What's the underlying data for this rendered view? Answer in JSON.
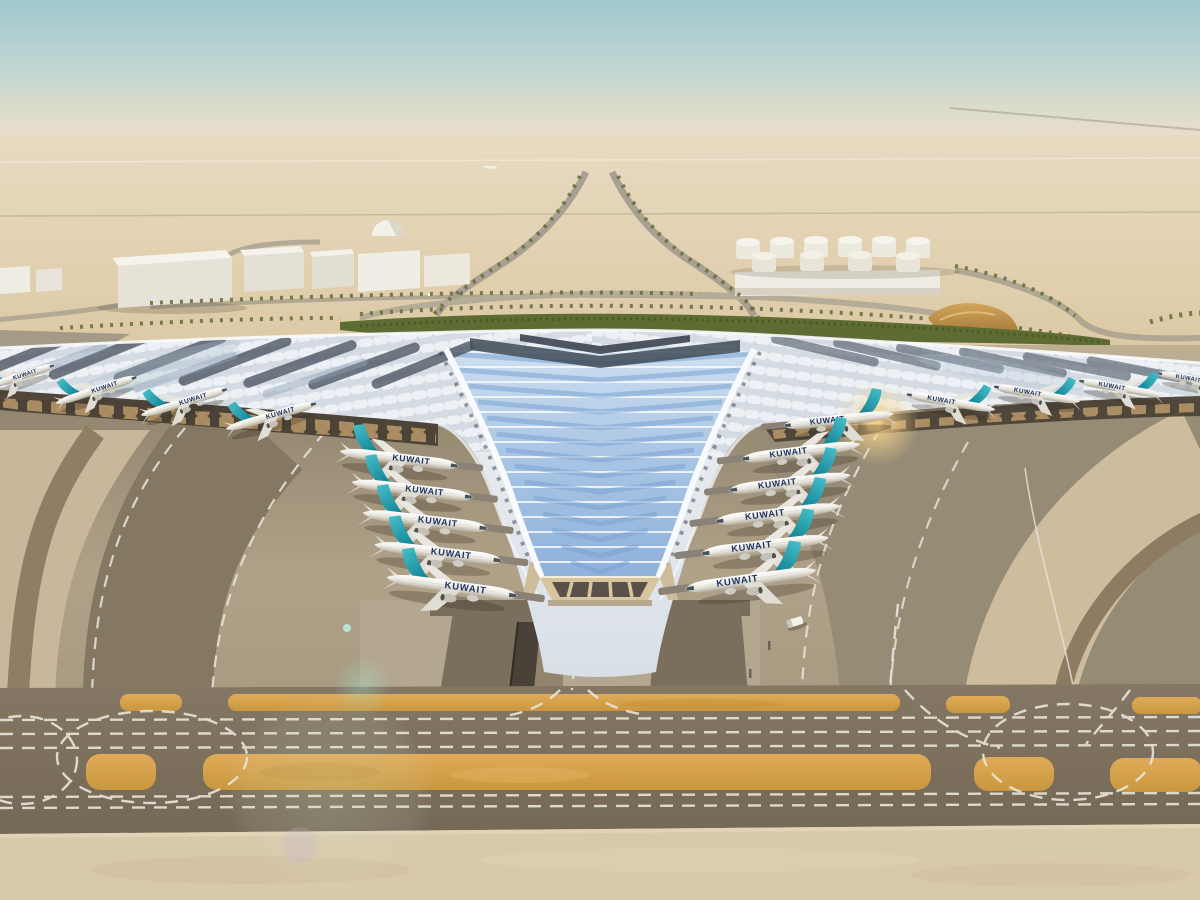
{
  "meta": {
    "subject": "aerial-architectural-rendering-airport-terminal",
    "description": "Aerial render of a desert airport terminal with winged solar roof and parked airliners"
  },
  "scene": {
    "airline_label": "KUWAIT",
    "colors": {
      "sky_top": "#9fc7cd",
      "sky_horizon": "#e9decc",
      "desert": "#dcc9a4",
      "roof_light": "#e6ebf0",
      "roof_solar_dark": "#46505c",
      "glass_blue": "#a7c4e4",
      "glass_chevron": "#7ba3d3",
      "tail_teal": "#2aa9b8",
      "fuselage_white": "#f5f4f0",
      "canopy_shadow": "#463e33",
      "facade_gold": "#c9a470",
      "apron_gray": "#94896f",
      "taxiway_band": "#7c7060",
      "paint_orange": "#d9a353",
      "marking_white": "#e9e5da",
      "greenery": "#5d6c33",
      "sand_bottom": "#d9c9ab"
    },
    "planes": [
      {
        "x": 18,
        "y": 377,
        "r": -18,
        "s": 0.62,
        "flip": false,
        "bridge": false
      },
      {
        "x": 97,
        "y": 390,
        "r": -18,
        "s": 0.68,
        "flip": false,
        "bridge": false
      },
      {
        "x": 185,
        "y": 402,
        "r": -17,
        "s": 0.72,
        "flip": false,
        "bridge": false
      },
      {
        "x": 272,
        "y": 416,
        "r": -16,
        "s": 0.75,
        "flip": false,
        "bridge": false
      },
      {
        "x": 400,
        "y": 459,
        "r": 7,
        "s": 0.95,
        "flip": false,
        "bridge": true
      },
      {
        "x": 413,
        "y": 490,
        "r": 7,
        "s": 0.97,
        "flip": false,
        "bridge": true
      },
      {
        "x": 426,
        "y": 521,
        "r": 7,
        "s": 1.0,
        "flip": false,
        "bridge": true
      },
      {
        "x": 439,
        "y": 553,
        "r": 7,
        "s": 1.02,
        "flip": false,
        "bridge": true
      },
      {
        "x": 453,
        "y": 587,
        "r": 8,
        "s": 1.05,
        "flip": false,
        "bridge": true
      },
      {
        "x": 838,
        "y": 420,
        "r": -6,
        "s": 0.88,
        "flip": true,
        "bridge": true
      },
      {
        "x": 800,
        "y": 452,
        "r": -7,
        "s": 0.95,
        "flip": true,
        "bridge": true
      },
      {
        "x": 789,
        "y": 483,
        "r": -7,
        "s": 0.97,
        "flip": true,
        "bridge": true
      },
      {
        "x": 777,
        "y": 514,
        "r": -7,
        "s": 1.0,
        "flip": true,
        "bridge": true
      },
      {
        "x": 764,
        "y": 546,
        "r": -7,
        "s": 1.02,
        "flip": true,
        "bridge": true
      },
      {
        "x": 750,
        "y": 580,
        "r": -8,
        "s": 1.05,
        "flip": true,
        "bridge": true
      },
      {
        "x": 950,
        "y": 402,
        "r": 10,
        "s": 0.72,
        "flip": true,
        "bridge": false
      },
      {
        "x": 1036,
        "y": 394,
        "r": 10,
        "s": 0.7,
        "flip": true,
        "bridge": false
      },
      {
        "x": 1120,
        "y": 388,
        "r": 10,
        "s": 0.68,
        "flip": true,
        "bridge": false
      },
      {
        "x": 1196,
        "y": 380,
        "r": 10,
        "s": 0.64,
        "flip": true,
        "bridge": false
      }
    ],
    "vehicles": [
      {
        "x": 795,
        "y": 622,
        "r": -18
      }
    ],
    "bollards": [
      {
        "x": 768,
        "y": 641
      },
      {
        "x": 749,
        "y": 669
      }
    ]
  }
}
